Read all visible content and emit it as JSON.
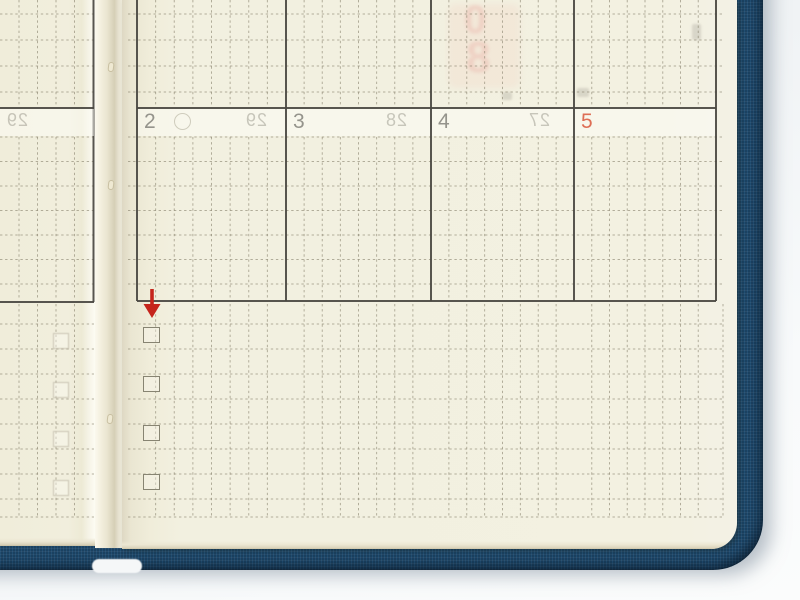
{
  "calendar": {
    "visible_dates": [
      {
        "label": "2",
        "color_role": "weekday_gray",
        "has_moon_circle": true,
        "showthrough": "29"
      },
      {
        "label": "3",
        "color_role": "weekday_gray",
        "has_moon_circle": false,
        "showthrough": "28"
      },
      {
        "label": "4",
        "color_role": "weekday_gray",
        "has_moon_circle": false,
        "showthrough": "27"
      },
      {
        "label": "5",
        "color_role": "holiday_red",
        "has_moon_circle": false,
        "showthrough": ""
      }
    ],
    "showthrough_large": [
      "0",
      "8"
    ]
  },
  "left_page": {
    "showthrough_date": "29",
    "showthrough_checkbox_count": 4
  },
  "checklist": {
    "checkbox_count": 4,
    "checkbox_states": [
      "empty",
      "empty",
      "empty",
      "empty"
    ],
    "annotation_arrow": {
      "direction": "down",
      "color": "#c5251c"
    }
  },
  "colors": {
    "cover_navy": "#1e486b",
    "paper_cream": "#f2efdf",
    "date_gray": "#95948c",
    "date_red": "#de6e55",
    "arrow_red": "#c5251c",
    "grid_dot": "#87816c",
    "table_line": "#4a4842",
    "desk_background": "#f0f3f5"
  }
}
